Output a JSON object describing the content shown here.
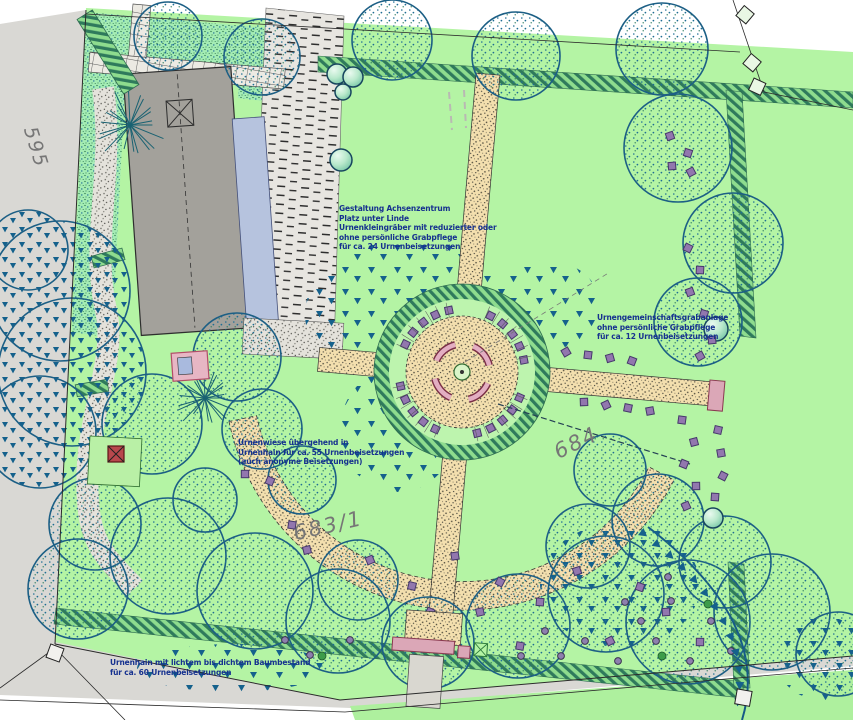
{
  "annotations": {
    "achsenzentrum": {
      "lines": [
        "Gestaltung Achsenzentrum",
        "Platz unter Linde",
        "Urnenkleingräber mit reduzierter oder",
        "ohne persönliche Grabpflege",
        "für ca. 24 Urnenbeisetzungen"
      ]
    },
    "gemeinschaftsgrab": {
      "lines": [
        "Urnengemeinschaftsgrabanlage",
        "ohne persönliche Grabpflege",
        "für ca. 12 Urnenbeisetzungen"
      ]
    },
    "urnenwiese": {
      "lines": [
        "Urnenwiese übergehend in",
        "Urnenhain für ca. 55 Urnenbeisetzungen",
        "(auch anonyme Beisetzungen)"
      ]
    },
    "urnenhain": {
      "lines": [
        "Urnenhain mit lichtem bis dichtem Baumbestand",
        "für ca. 60 Urnenbeisetzungen"
      ]
    }
  },
  "parcels": {
    "west": "595",
    "east": "684",
    "south": "683/1"
  },
  "symbols": {
    "tree": "stippled-canopy-circle",
    "conifer_planting": "small-teal-triangle",
    "urn_grave": "purple-square",
    "community_grave": "purple-dot",
    "bench": "pink-arc",
    "hedge": "diagonal-hatch-band",
    "boundary_marker": "rotated-square"
  },
  "colors": {
    "lawn_green": "#b4f4a4",
    "planting_mint": "#a4ecb4",
    "path_sand": "#f3dfae",
    "outside_gray": "#d9d8d4",
    "hedge_teal": "#2f7a5c",
    "tree_blue": "#1c5f85",
    "grave_purple": "#9277ae",
    "accent_pink": "#dba7b7",
    "building_gray": "#a3a19b",
    "water_blue": "#b6c3de",
    "annotation_blue": "#16318f",
    "parcel_gray": "#767676"
  }
}
